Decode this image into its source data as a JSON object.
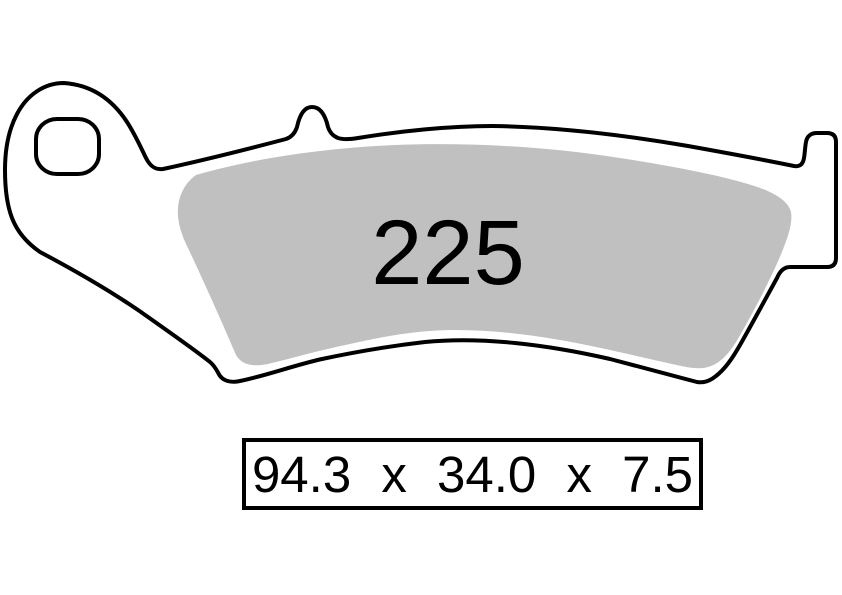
{
  "pad": {
    "compound_number": "225"
  },
  "dimensions_box": {
    "text": "94.3 x 34.0 x 7.5",
    "width_mm": "94.3",
    "height_mm": "34.0",
    "thickness_mm": "7.5",
    "separator": "x"
  },
  "colors": {
    "background": "#ffffff",
    "outline": "#000000",
    "backplate_fill": "#ffffff",
    "friction_material_fill": "#c0c0c0",
    "text": "#000000"
  }
}
